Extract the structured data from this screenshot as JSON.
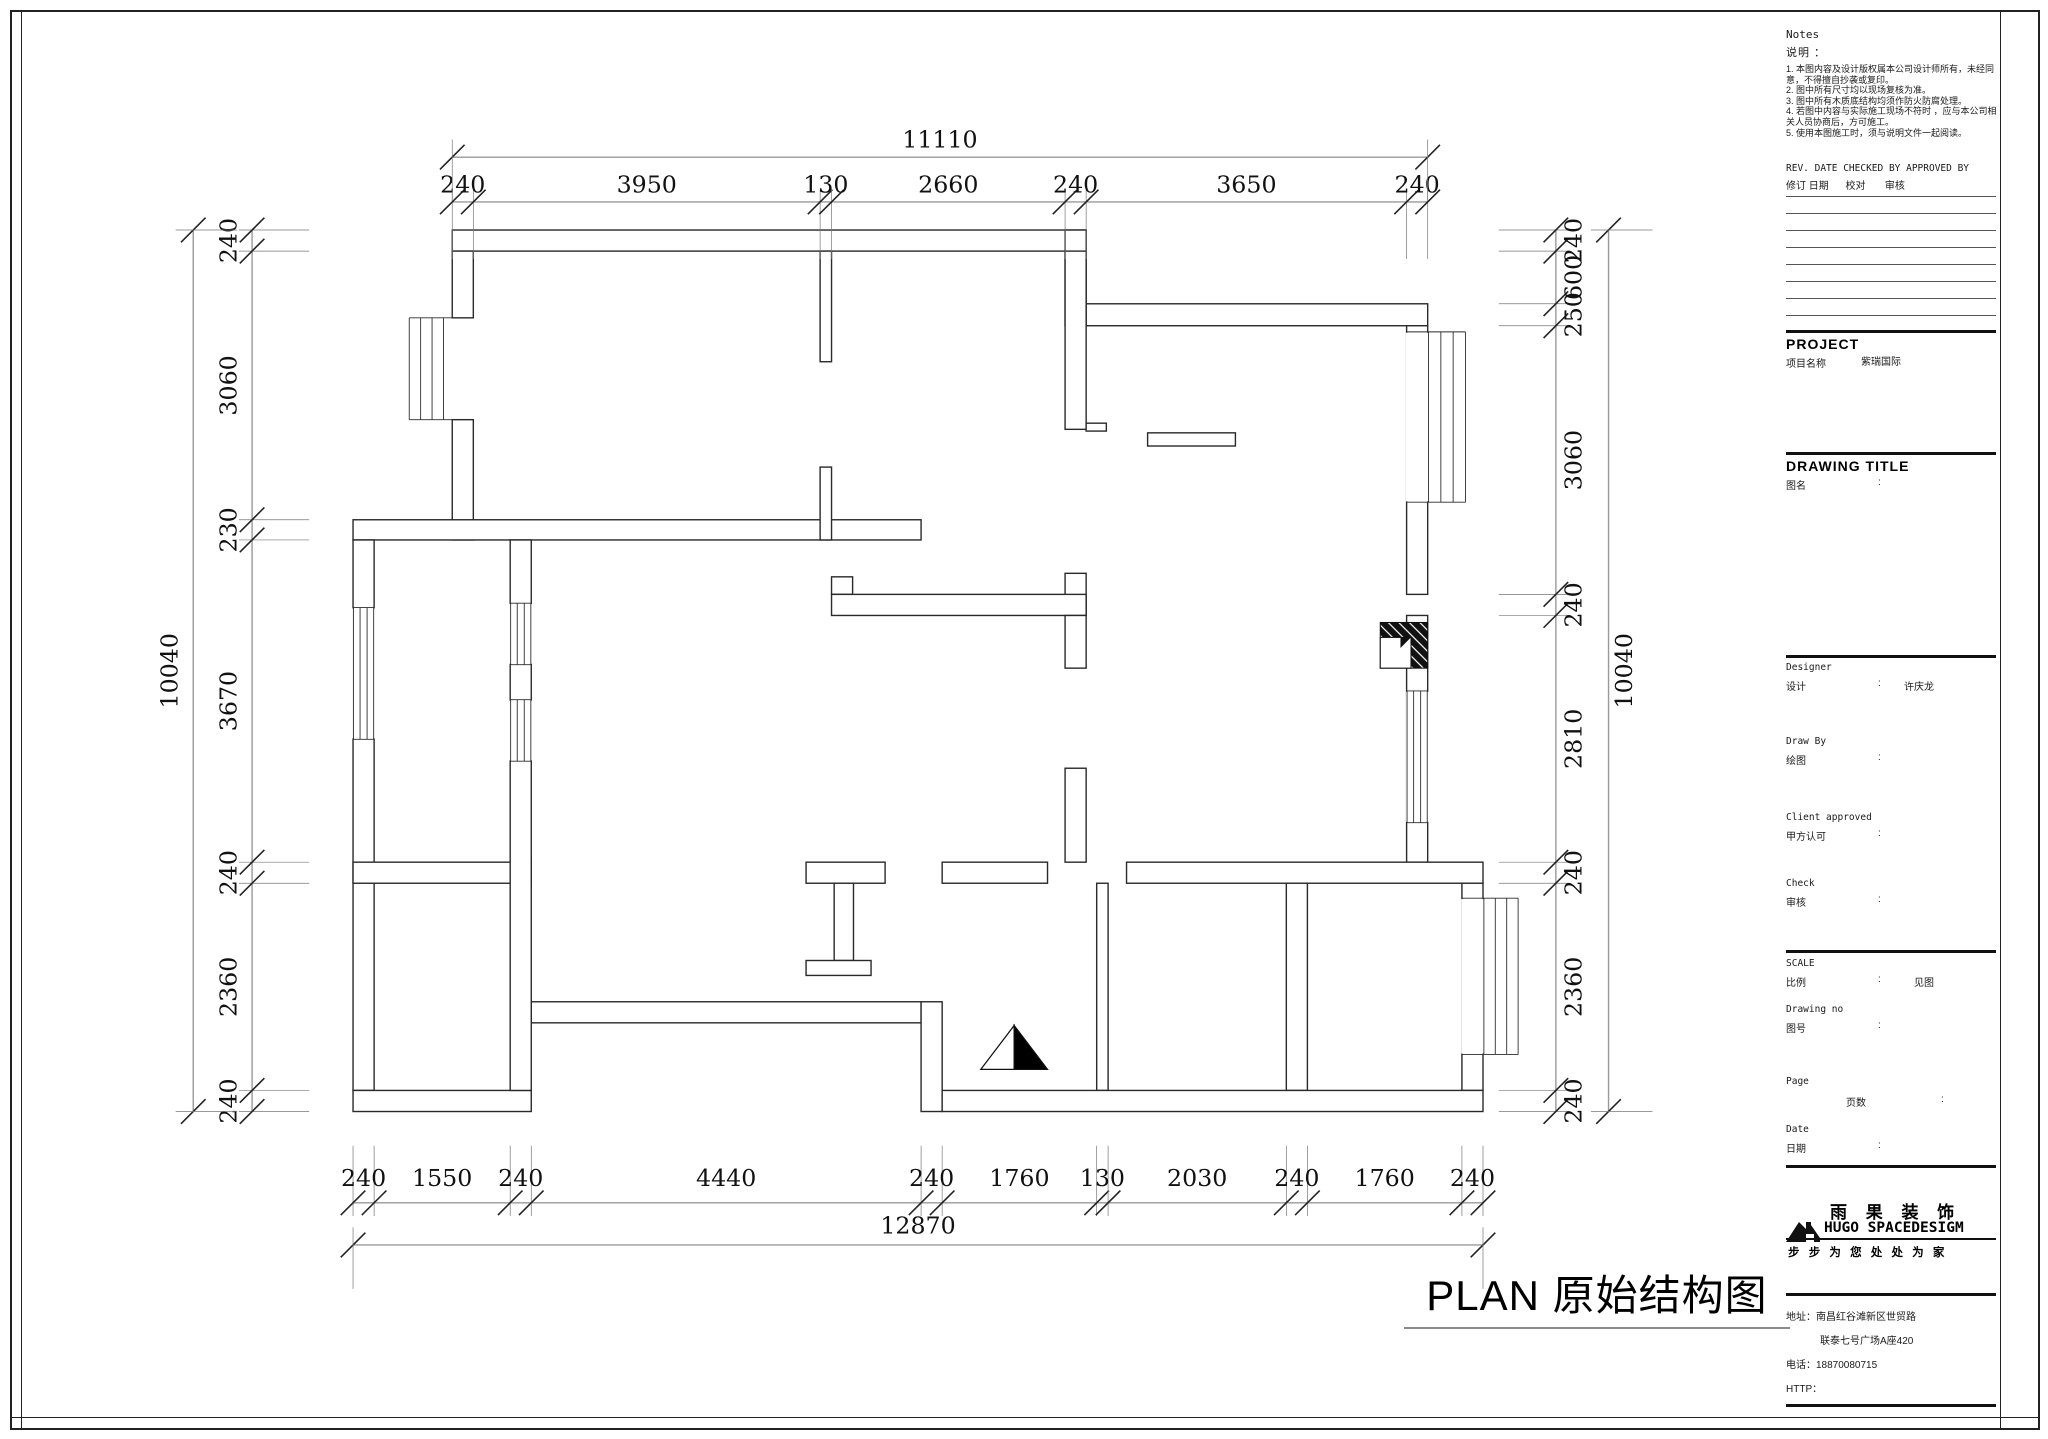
{
  "colon": ":",
  "plan": {
    "title": "PLAN 原始结构图"
  },
  "notes": {
    "title_en": "Notes",
    "title_cn": "说明 ：",
    "items": [
      "1. 本图内容及设计版权属本公司设计师所有，未经同意，不得擅自抄袭或复印。",
      "2. 图中所有尺寸均以现场复核为准。",
      "3. 图中所有木质底结构均须作防火防腐处理。",
      "4. 若图中内容与实际施工现场不符时 ，应与本公司相关人员协商后，方可施工。",
      "5. 使用本图施工时，须与说明文件一起阅读。"
    ]
  },
  "rev_table": {
    "header_en": "REV. DATE CHECKED BY APPROVED BY",
    "header_cn": "修订 日期      校对       审核"
  },
  "project": {
    "label_en": "PROJECT",
    "label_cn": "项目名称",
    "value": "紫瑞国际"
  },
  "drawing_title": {
    "label_en": "DRAWING TITLE",
    "label_cn": "图名"
  },
  "people": {
    "designer_en": "Designer",
    "designer_cn": "设计",
    "designer_value": "许庆龙",
    "drawby_en": "Draw By",
    "drawby_cn": "绘图",
    "client_en": "Client approved",
    "client_cn": "甲方认可",
    "check_en": "Check",
    "check_cn": "审核"
  },
  "meta": {
    "scale_en": "SCALE",
    "scale_cn": "比例",
    "scale_value": "见图",
    "drawingno_en": "Drawing  no",
    "drawingno_cn": "图号",
    "page_en": "Page",
    "page_cn": "页数",
    "date_en": "Date",
    "date_cn": "日期"
  },
  "brand": {
    "name_cn": "雨 果 装 饰",
    "name_en": "HUGO SPACEDESIGM",
    "slogan": "步 步 为 您   处 处 为 家"
  },
  "contact": {
    "address1": "地址：南昌红谷滩新区世贸路",
    "address2": "联泰七号广场A座420",
    "phone": "电话：18870080715",
    "http": "HTTP："
  },
  "dims": {
    "top": {
      "overall": "11110",
      "segments": [
        "240",
        "3950",
        "130",
        "2660",
        "240",
        "3650",
        "240"
      ]
    },
    "bottom": {
      "overall": "12870",
      "segments": [
        "240",
        "1550",
        "240",
        "4440",
        "240",
        "1760",
        "130",
        "2030",
        "240",
        "1760",
        "240"
      ]
    },
    "left": {
      "overall": "10040",
      "segments": [
        "240",
        "3060",
        "230",
        "3670",
        "240",
        "2360",
        "240"
      ]
    },
    "right": {
      "overall": "10040",
      "segments": [
        "240",
        "600",
        "250",
        "3060",
        "240",
        "2810",
        "240",
        "2360",
        "240"
      ]
    }
  }
}
